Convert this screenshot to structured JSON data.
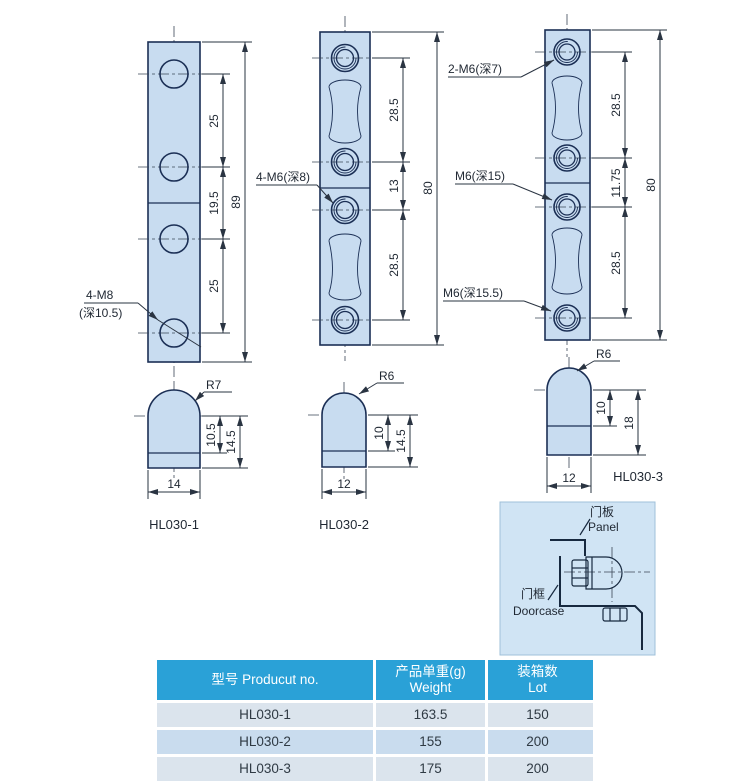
{
  "colors": {
    "plate_fill": "#c8dcf0",
    "outline": "#1b2f55",
    "table_header_bg": "#2aa1d7",
    "table_header_text": "#ffffff",
    "row_light": "#dbe4ed",
    "row_blue": "#c9dcee",
    "inset_bg": "#d0e4f4"
  },
  "front1": {
    "d1": "25",
    "d2": "19.5",
    "d3": "25",
    "total": "89",
    "tap_l1": "4-M8",
    "tap_l2": "(深10.5)"
  },
  "front2": {
    "d1": "28.5",
    "d2": "13",
    "d3": "28.5",
    "total": "80",
    "tap": "4-M6(深8)"
  },
  "front3": {
    "d1": "28.5",
    "d2": "11.75",
    "d3": "28.5",
    "total": "80",
    "tap_top": "2-M6(深7)",
    "tap_mid": "M6(深15)",
    "tap_bot": "M6(深15.5)"
  },
  "side1": {
    "radius": "R7",
    "h_inner": "10.5",
    "h_total": "14.5",
    "width": "14",
    "caption": "HL030-1"
  },
  "side2": {
    "radius": "R6",
    "h_inner": "10",
    "h_total": "14.5",
    "width": "12",
    "caption": "HL030-2"
  },
  "side3": {
    "radius": "R6",
    "h_inner": "10",
    "h_total": "18",
    "width": "12",
    "caption": "HL030-3"
  },
  "inset": {
    "panel_cn": "门板",
    "panel_en": "Panel",
    "doorcase_cn": "门框",
    "doorcase_en": "Doorcase"
  },
  "table": {
    "headers": {
      "product_no": "型号 Producut no.",
      "weight_cn": "产品单重(g)",
      "weight_en": "Weight",
      "lot_cn": "装箱数",
      "lot_en": "Lot"
    },
    "rows": [
      [
        "HL030-1",
        "163.5",
        "150"
      ],
      [
        "HL030-2",
        "155",
        "200"
      ],
      [
        "HL030-3",
        "175",
        "200"
      ]
    ]
  }
}
